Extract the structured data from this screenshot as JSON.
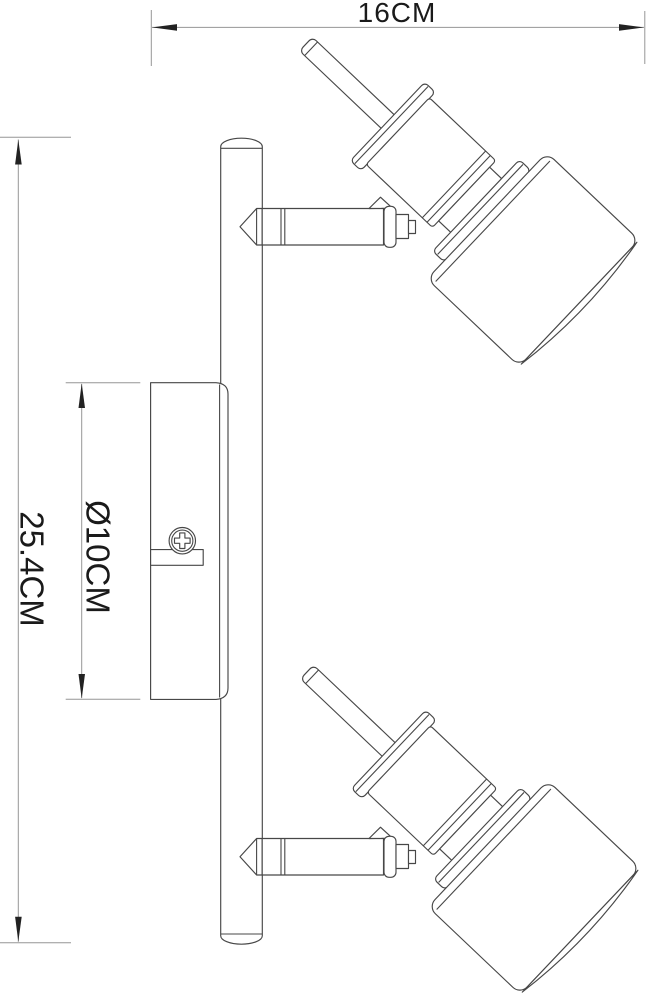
{
  "dimensions": {
    "width": {
      "label": "16CM"
    },
    "height": {
      "label": "25.4CM"
    },
    "diameter": {
      "label": "Ø10CM"
    }
  },
  "colors": {
    "background": "#ffffff",
    "outline": "#474747",
    "dimension_line": "#969696",
    "arrow": "#222222",
    "text": "#1a1a1a"
  }
}
